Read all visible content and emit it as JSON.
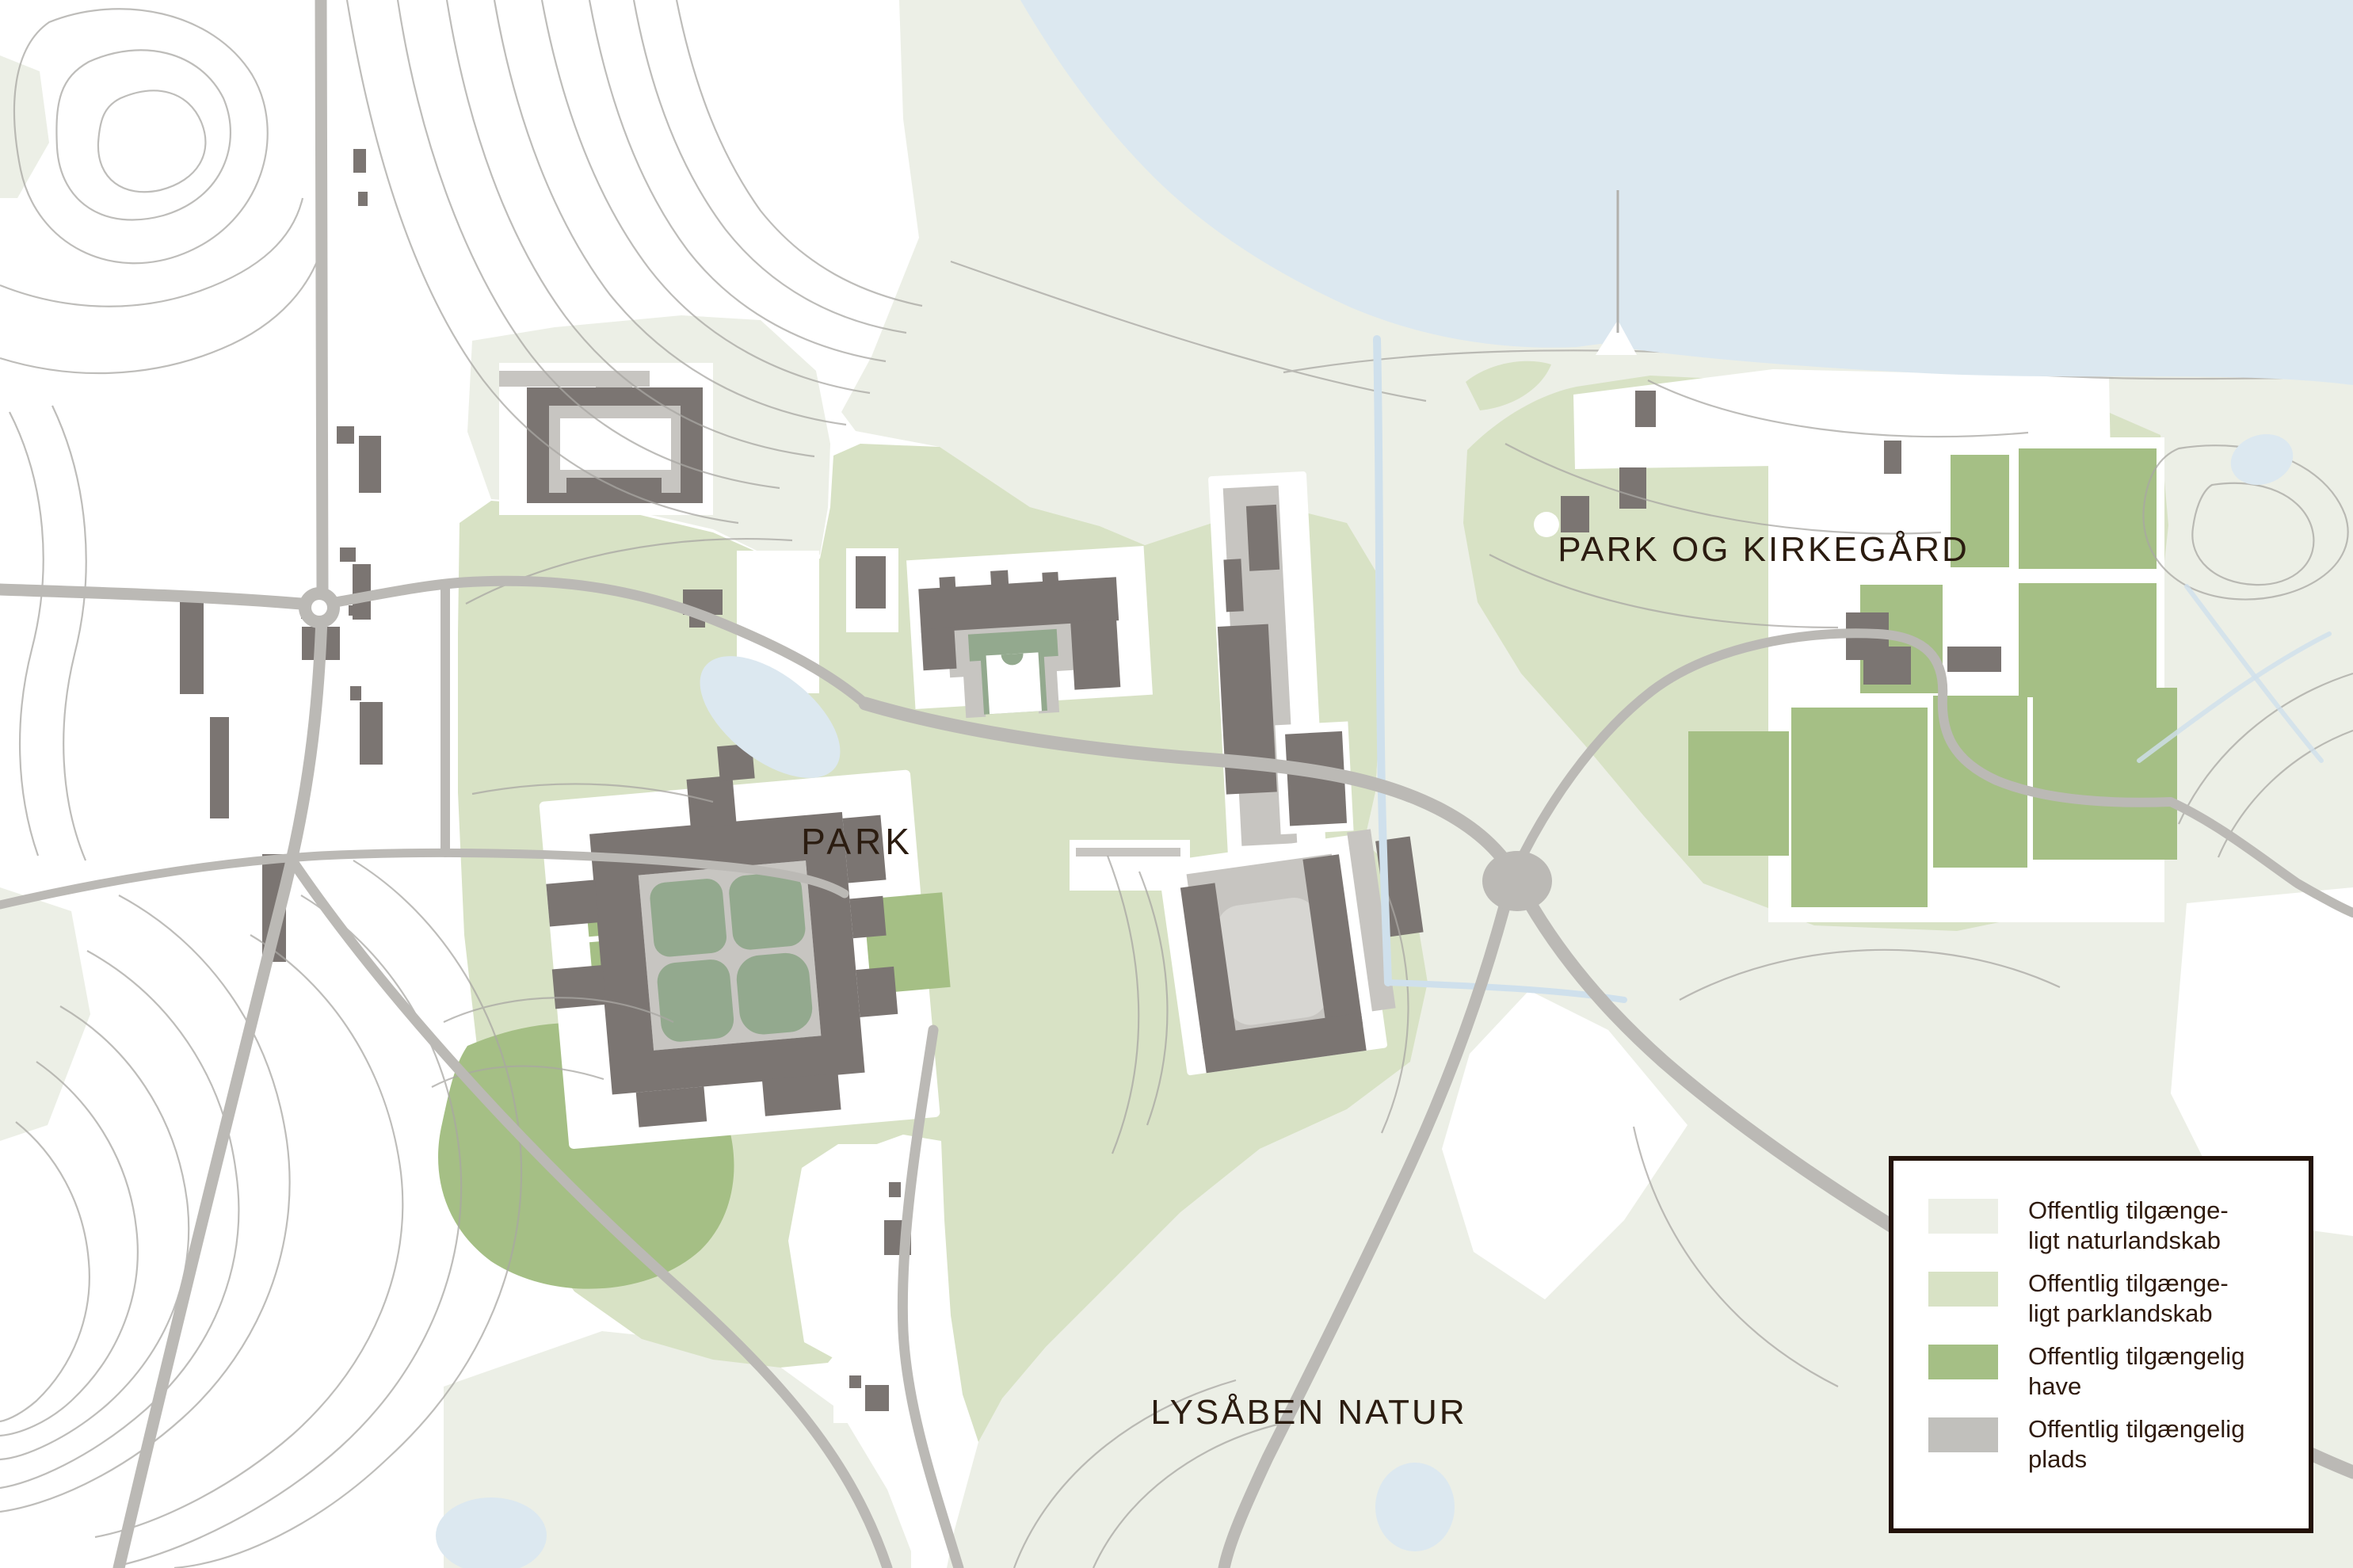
{
  "map": {
    "labels": {
      "park": "PARK",
      "park_and_cemetery": "PARK OG KIRKEGÅRD",
      "open_nature": "LYSÅBEN NATUR"
    },
    "colors": {
      "water": "#dce8f0",
      "stream": "#cfe0ec",
      "natural_landscape": "#ecefe6",
      "park_landscape": "#d8e2c5",
      "garden": "#a5bf85",
      "courtyard_green": "#93a98e",
      "plaza": "#c7c5c1",
      "plaza_light": "#d7d6d2",
      "building": "#7b7572",
      "road": "#bbb9b5",
      "contour": "#a9a7a3",
      "label_text": "#2b1c10"
    }
  },
  "legend": {
    "items": [
      {
        "line1": "Offentlig tilgænge-",
        "line2": "ligt naturlandskab",
        "color": "#ecefe6"
      },
      {
        "line1": "Offentlig tilgænge-",
        "line2": "ligt parklandskab",
        "color": "#d8e2c5"
      },
      {
        "line1": "Offentlig tilgængelig",
        "line2": "have",
        "color": "#a5bf85"
      },
      {
        "line1": "Offentlig tilgængelig",
        "line2": "plads",
        "color": "#c1c0bc"
      }
    ]
  }
}
